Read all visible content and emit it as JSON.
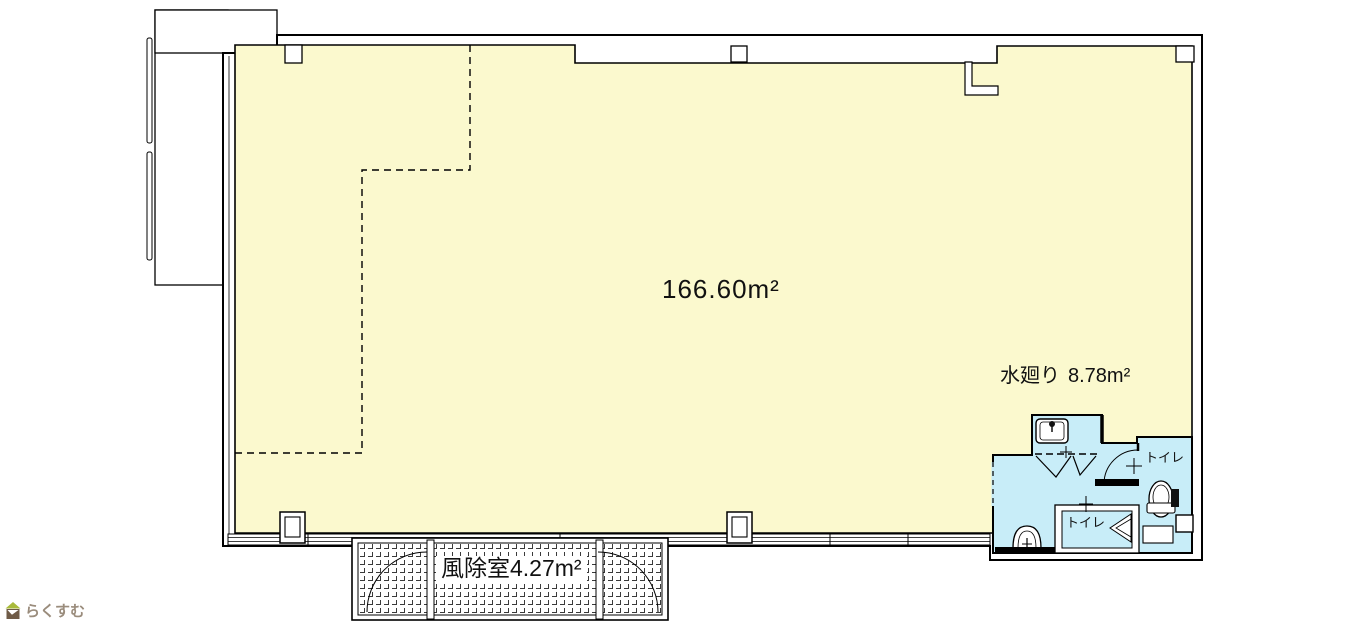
{
  "floor_plan": {
    "main_room": {
      "area_label": "166.60m²"
    },
    "wet_area": {
      "label": "水廻り",
      "area_label": "8.78m²",
      "toilet_right_label": "トイレ",
      "toilet_middle_label": "トイレ"
    },
    "vestibule": {
      "label": "風除室",
      "area_label": "4.27m²"
    },
    "colors": {
      "room_fill": "#FBF9CE",
      "wet_fill": "#C8EDF8",
      "wall_line": "#000000"
    }
  },
  "branding": {
    "logo_text": "らくすむ"
  }
}
